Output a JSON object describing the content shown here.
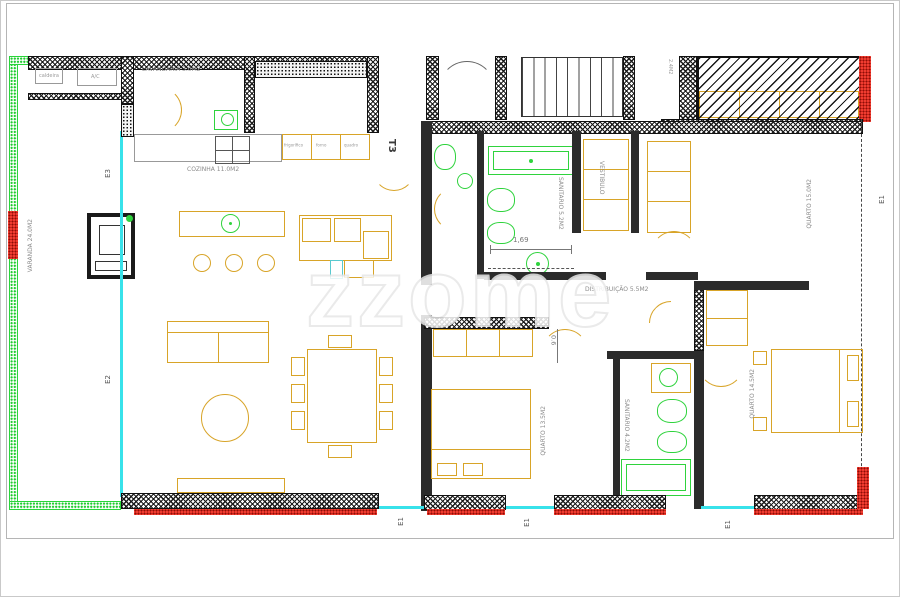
{
  "plan": {
    "type": "T3",
    "watermark": "zzome"
  },
  "rooms": {
    "lavandaria": "LAVANDARIA 3.0M2",
    "cozinha": "COZINHA 11.0M2",
    "sanitario_principal": "SANITARIO 5.2M2",
    "vestibulo": "VESTIBULO",
    "distribuicao": "DISTRIBUIÇÃO 5.5M2",
    "quarto_1": "QUARTO 15.0M2",
    "quarto_2": "QUARTO 14.5M2",
    "quarto_3": "QUARTO 13.5M2",
    "sanitario_suite": "SANITARIO 4.2M2",
    "varanda": "VARANDA 24.0M2",
    "area_pequena": "2.4M2"
  },
  "appliances": {
    "caldeira": "caldeira",
    "ac": "A/C",
    "frigorifico": "frigorífico",
    "forno": "forno",
    "quadro": "quadro"
  },
  "dimensions": {
    "largura_sanitario": "1,69",
    "passagem": "0.6"
  },
  "markers": {
    "e1": "E1",
    "e2": "E2",
    "e3": "E3"
  },
  "colors": {
    "furniture_yellow": "#d8a428",
    "fixture_green": "#2fd33d",
    "glass_cyan": "#38e2ea",
    "wall_red": "#f03c30",
    "varanda_green": "#29d53a"
  }
}
